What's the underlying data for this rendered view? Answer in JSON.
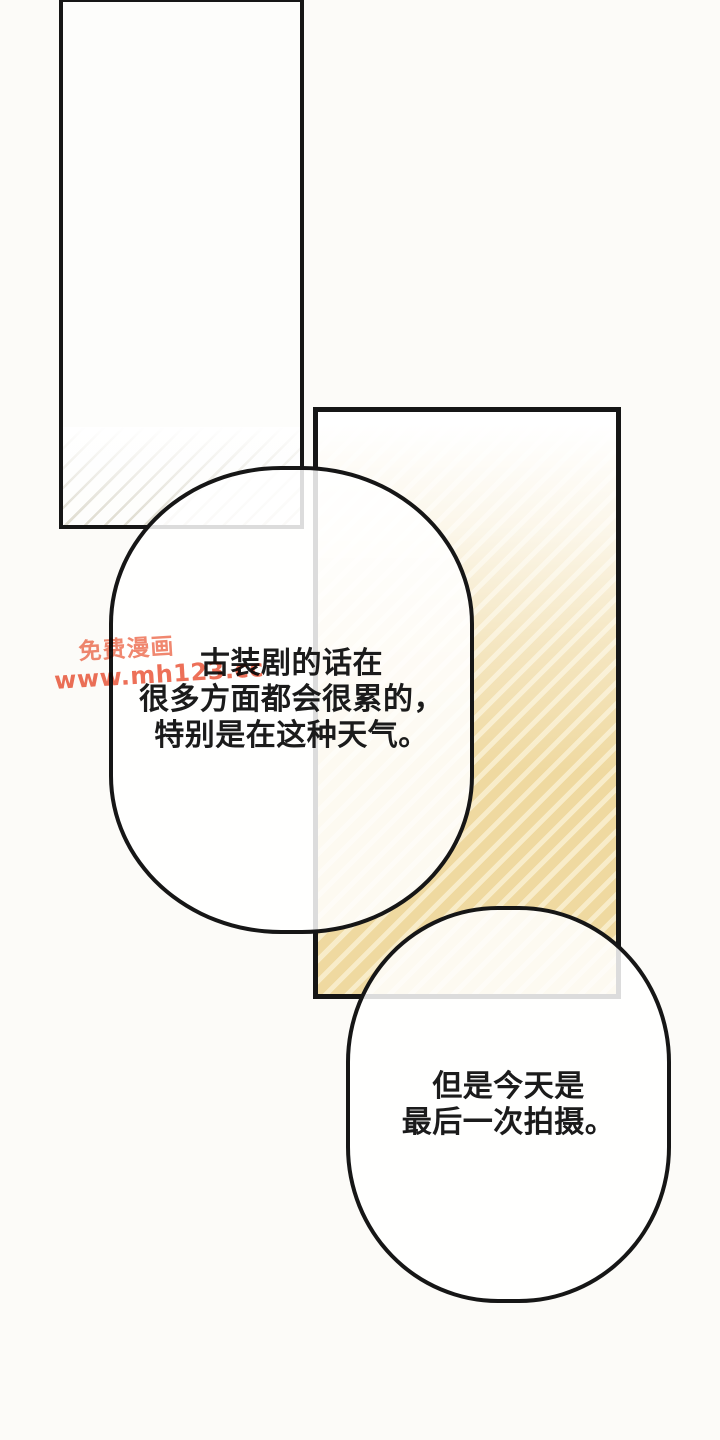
{
  "page": {
    "kind": "comic-page"
  },
  "colors": {
    "paper": "#fcfbf8",
    "ink": "#161616",
    "text": "#1b1b1b",
    "tan-dark": "#efd9a0",
    "tan-light": "#f8ecc9",
    "wm1": "#f0876f",
    "wm2": "#ed7058"
  },
  "bubbles": [
    {
      "id": "bubble-1",
      "lines": [
        "古装剧的话在",
        "很多方面都会很累的，",
        "特别是在这种天气。"
      ]
    },
    {
      "id": "bubble-2",
      "lines": [
        "但是今天是",
        "最后一次拍摄。"
      ]
    }
  ],
  "watermark": {
    "name": "免费漫画",
    "url": "www.mh123.cc"
  }
}
